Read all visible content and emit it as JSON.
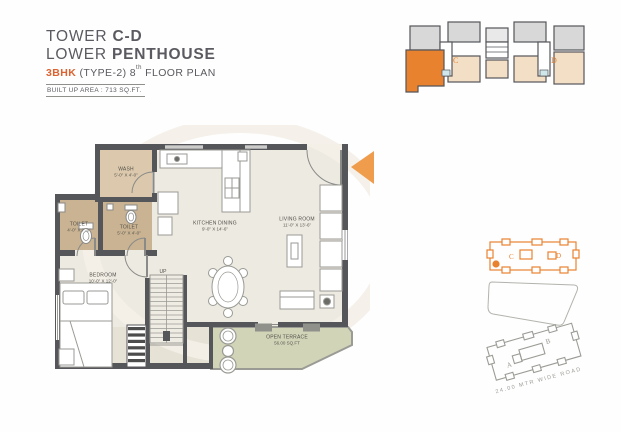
{
  "header": {
    "line1_prefix": "TOWER ",
    "line1_bold": "C-D",
    "line2_prefix": "LOWER ",
    "line2_bold": "PENTHOUSE",
    "line3_bhk": "3BHK",
    "line3_type": " (TYPE-2) ",
    "line3_floor_num": "8",
    "line3_floor_sup": "th",
    "line3_floor_rest": " FLOOR PLAN",
    "builtup_area": "BUILT UP AREA : 713 SQ.FT."
  },
  "rooms": {
    "wash": {
      "name": "WASH",
      "dims": "5'-0\" X 4'-0\""
    },
    "toilet_left": {
      "name": "TOILET",
      "dims": "4'-0\" X 7'-0\""
    },
    "toilet_mid": {
      "name": "TOILET",
      "dims": "5'-0\" X 4'-0\""
    },
    "kitchen_dining": {
      "name": "KITCHEN DINING",
      "dims": "9'-0\" X 14'-6\""
    },
    "living": {
      "name": "LIVING ROOM",
      "dims": "11'-0\" X 13'-6\""
    },
    "bedroom": {
      "name": "BEDROOM",
      "dims": "10'-0\" X 12'-0\""
    },
    "stairs_label": "UP",
    "terrace": {
      "name": "OPEN TERRACE",
      "area": "56.00 SQ.FT"
    }
  },
  "keyplan": {
    "tower_c": "C",
    "tower_d": "D"
  },
  "siteplan": {
    "tower_c": "C",
    "tower_d": "D",
    "tower_a": "A",
    "tower_b": "B",
    "road": "24.00 MTR WIDE ROAD"
  },
  "colors": {
    "accent_orange": "#e8822f",
    "arrow_orange": "#ef9c4d",
    "wall_gray": "#55565a",
    "floor_beige": "#edeae2",
    "wash_tan": "#dcc9ad",
    "toilet_tan": "#c9b392",
    "terrace_green": "#d2d4b8",
    "text_gray": "#5a5a60"
  }
}
